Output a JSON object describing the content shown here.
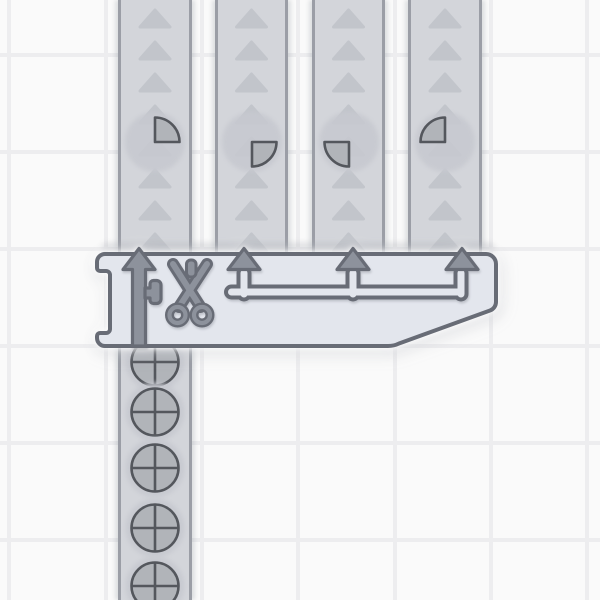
{
  "board": {
    "kind": "conveyor-factory-grid",
    "grid_line_color": "#ededef",
    "background": "#fafafa"
  },
  "colors": {
    "belt_fill": "#d3d5da",
    "belt_border": "#9b9ea6",
    "belt_chevron": "#c2c5cb",
    "machine_body": "#e3e6ed",
    "outline": "#686c76",
    "metal": "#8d929c",
    "shape_fill": "#b1b4b9",
    "shape_stroke": "#54575d",
    "ghost": "#c7c9d0"
  },
  "machine": {
    "type": "cutter",
    "icon": "scissors",
    "port_arrow_count": 4,
    "arrow_direction": "up"
  },
  "input_belt": {
    "name": "input-lane",
    "items": [
      {
        "shape": "circle-quartered"
      },
      {
        "shape": "circle-quartered"
      },
      {
        "shape": "circle-quartered"
      },
      {
        "shape": "circle-quartered"
      },
      {
        "shape": "circle-quartered"
      }
    ]
  },
  "output_lanes": [
    {
      "name": "lane-1",
      "item": {
        "shape": "quarter-circle",
        "quadrant": "top-right",
        "rotation_deg": "0",
        "svg_transform": "rotate(0 32 32)"
      }
    },
    {
      "name": "lane-2",
      "item": {
        "shape": "quarter-circle",
        "quadrant": "bottom-right",
        "rotation_deg": "90",
        "svg_transform": "rotate(90 32 32)"
      }
    },
    {
      "name": "lane-3",
      "item": {
        "shape": "quarter-circle",
        "quadrant": "bottom-left",
        "rotation_deg": "180",
        "svg_transform": "rotate(180 32 32)"
      }
    },
    {
      "name": "lane-4",
      "item": {
        "shape": "quarter-circle",
        "quadrant": "top-left",
        "rotation_deg": "270",
        "svg_transform": "rotate(270 32 32)"
      }
    }
  ]
}
